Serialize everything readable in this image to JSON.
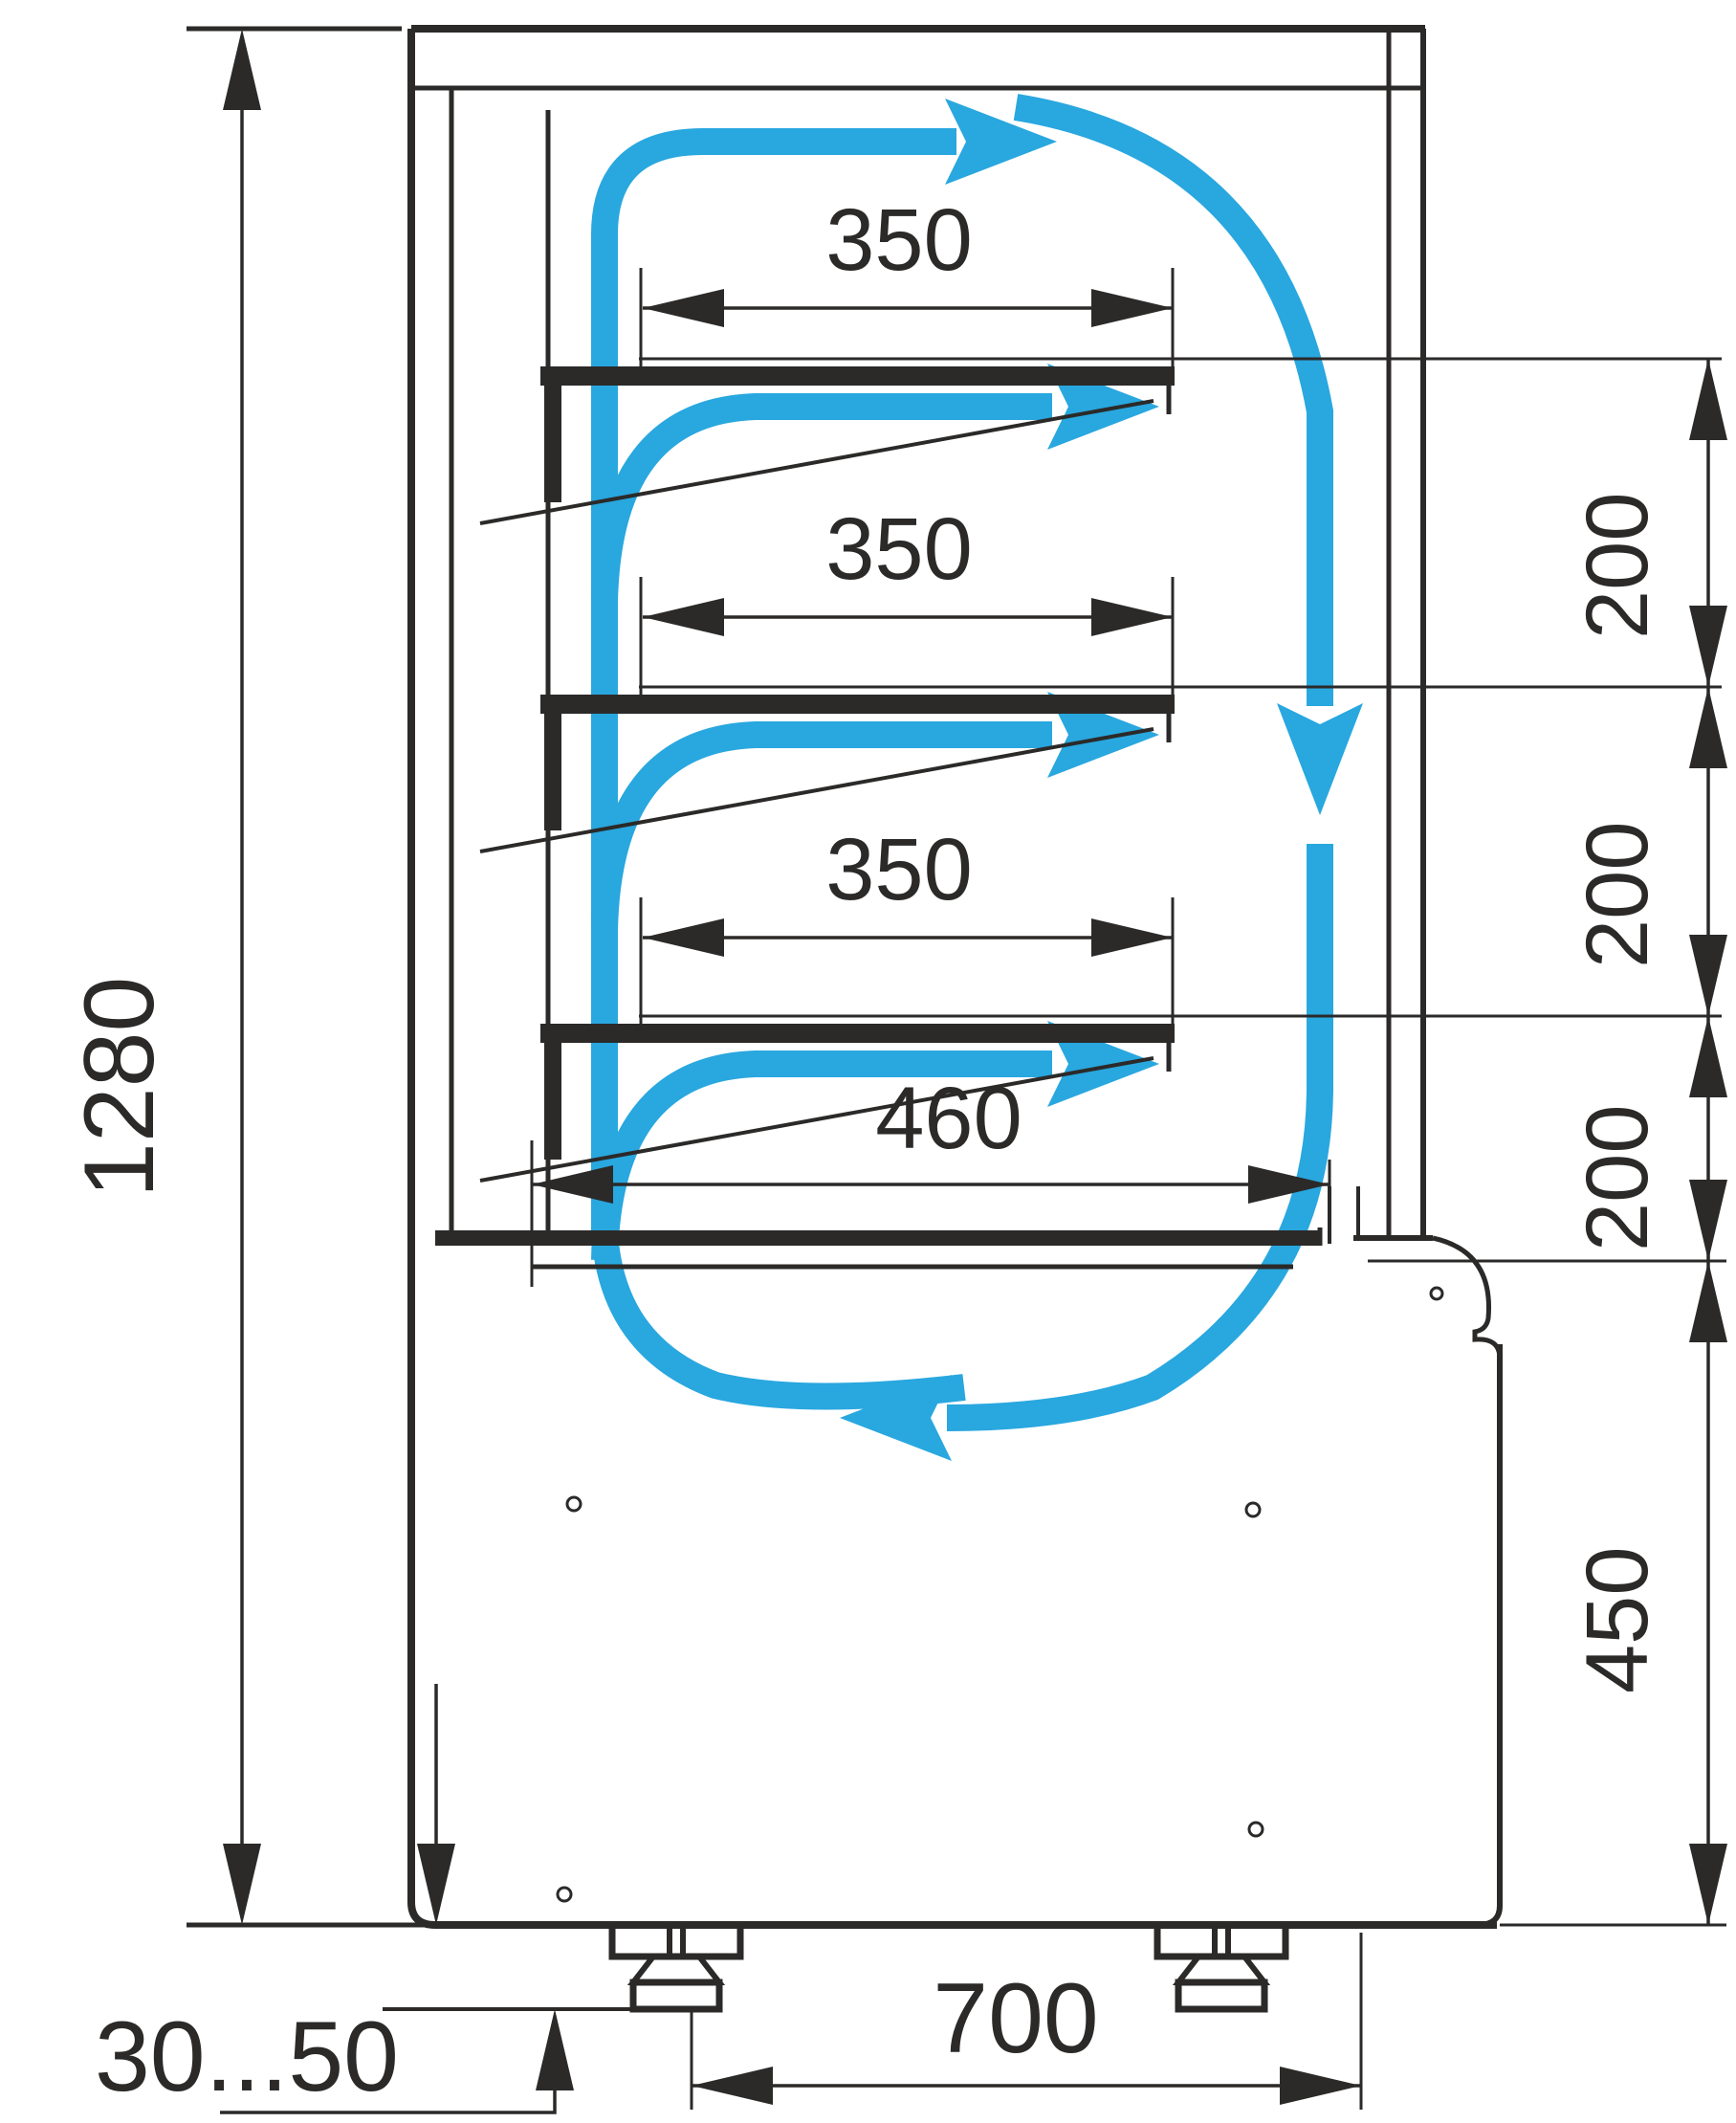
{
  "drawing": {
    "type": "refrigerated-display-case-side-section",
    "units_shown": false,
    "colors": {
      "line": "#2b2a29",
      "airflow": "#29a7df",
      "background": "#ffffff"
    },
    "dims": {
      "total_height": "1280",
      "shelf_1_depth": "350",
      "shelf_2_depth": "350",
      "shelf_3_depth": "350",
      "gap_1": "200",
      "gap_2": "200",
      "gap_3": "200",
      "deck_depth": "460",
      "lower_section_height": "450",
      "base_width": "700",
      "leg_adjust_range": "30...50"
    },
    "airflow_arrows": [
      "top-duct-arrow-right",
      "shelf-1-outlet-arrow-right",
      "shelf-2-outlet-arrow-right",
      "shelf-3-outlet-arrow-right",
      "front-glass-down-arrow",
      "bottom-return-arrow-left"
    ]
  }
}
